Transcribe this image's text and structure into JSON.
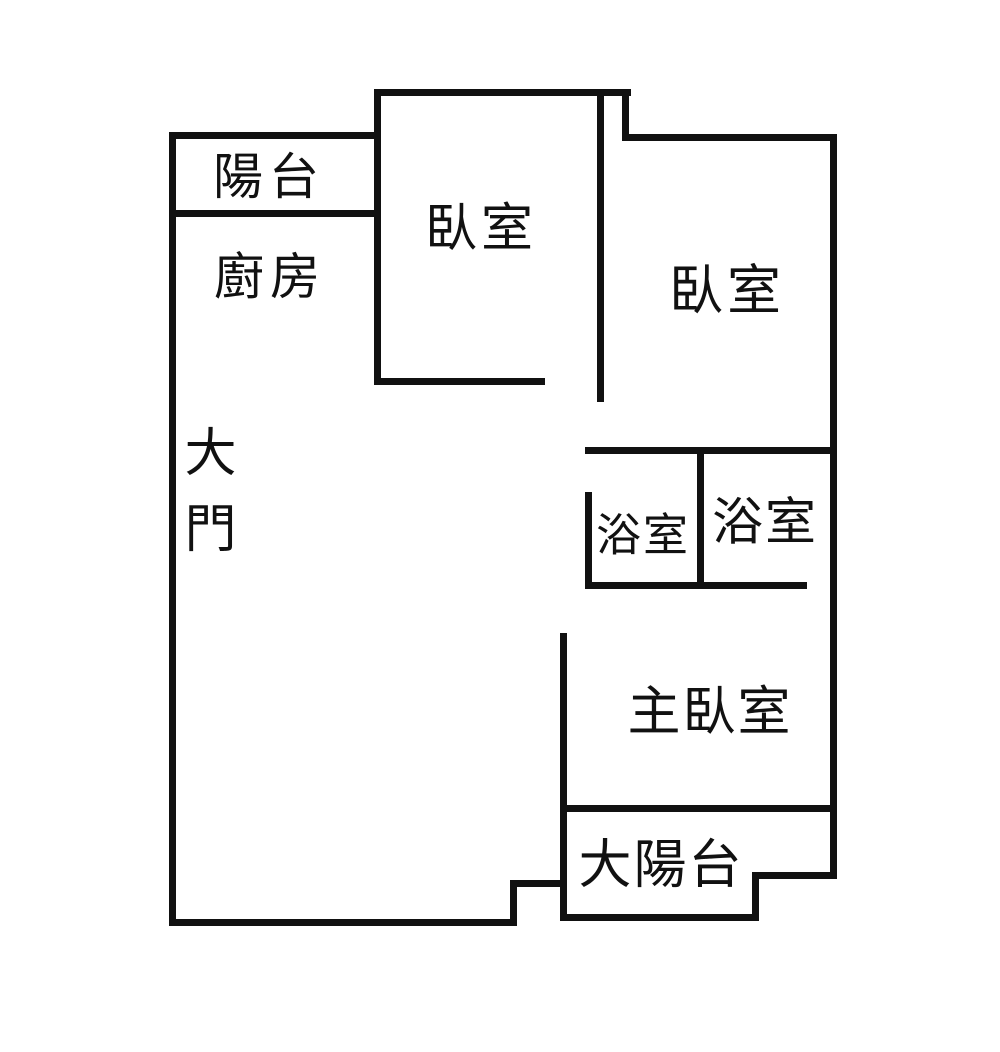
{
  "diagram_type": "apartment-floor-plan",
  "colors": {
    "wall": "#111111",
    "background": "#ffffff",
    "text": "#111111"
  },
  "rooms": {
    "balcony": {
      "label": "陽台"
    },
    "kitchen": {
      "label": "廚房"
    },
    "bedroom_top": {
      "label": "臥室"
    },
    "bedroom_right": {
      "label": "臥室"
    },
    "main_door": {
      "label": "大門"
    },
    "bath_left": {
      "label": "浴室"
    },
    "bath_right": {
      "label": "浴室"
    },
    "master_bedroom": {
      "label": "主臥室"
    },
    "big_balcony": {
      "label": "大陽台"
    }
  }
}
